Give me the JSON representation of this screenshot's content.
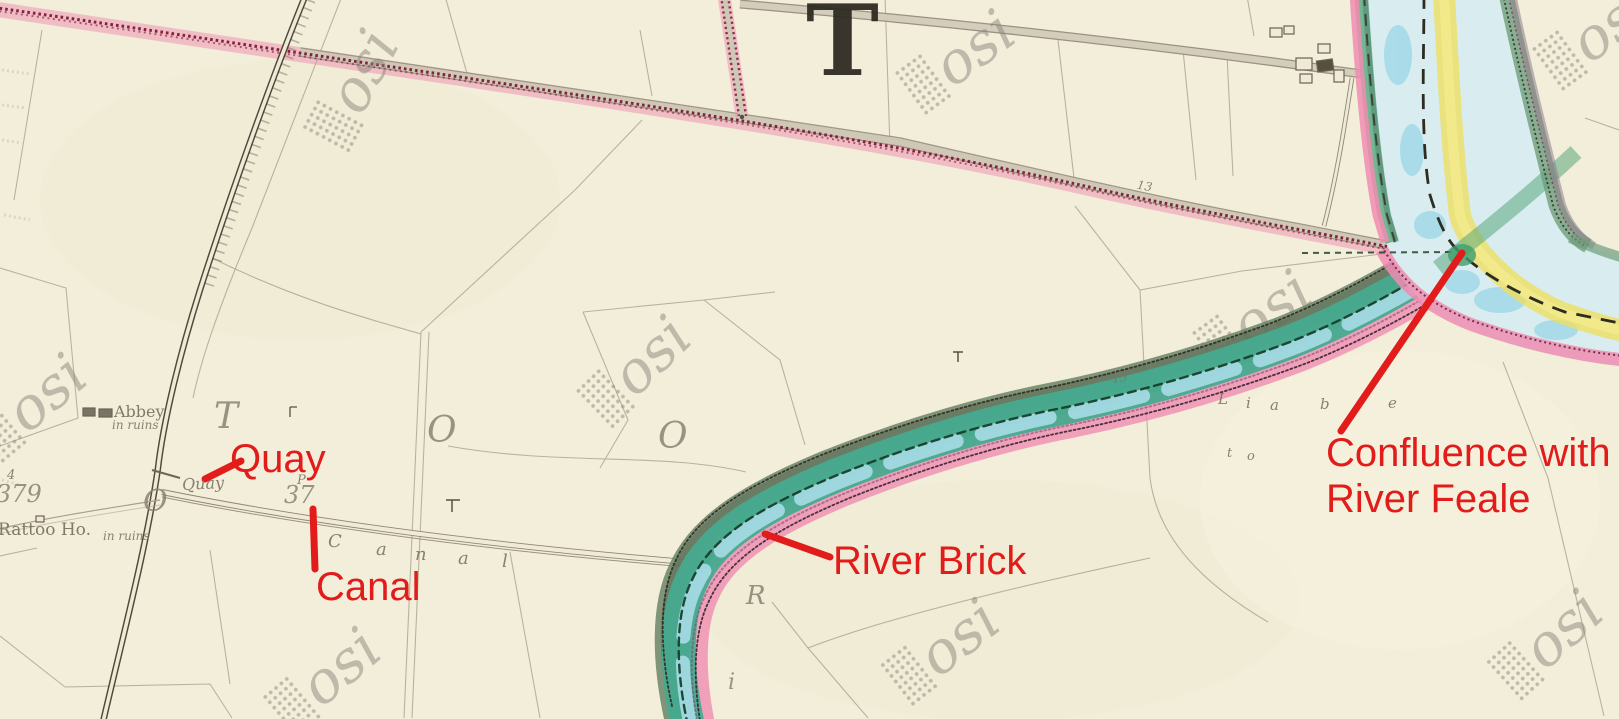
{
  "annotations": {
    "quay": {
      "label": "Quay"
    },
    "canal": {
      "label": "Canal"
    },
    "river_brick": {
      "label": "River Brick"
    },
    "confluence": {
      "line1": "Confluence with",
      "line2": "River Feale"
    },
    "color": "#e21b1b"
  },
  "map_labels": {
    "townland_initial_large": "T",
    "townland_letters": [
      "T",
      "O",
      "O"
    ],
    "o_at_quay": "O",
    "riverside_letters": [
      "R",
      "i"
    ],
    "quay_point": "Quay",
    "canal_spread": [
      "C",
      "a",
      "n",
      "a",
      "l"
    ],
    "abbey": {
      "name": "Abbey",
      "condition": "in ruins"
    },
    "rattoo": {
      "name": "Rattoo Ho.",
      "condition": "in ruins"
    },
    "liable_letters": [
      "L",
      "i",
      "a",
      "b",
      "e"
    ],
    "to_letters": [
      "t",
      "o"
    ],
    "numbers": {
      "bench_small": "4",
      "left_plot": "379",
      "p_small": "P",
      "canal_plot": "37",
      "plot_a": "15",
      "plot_b": "13"
    }
  },
  "watermark": {
    "text": "osi",
    "color": "#8b867c"
  },
  "map_colors": {
    "paper": "#f3eed9",
    "annotation_red": "#e21b1b",
    "river_teal": "#47ab8f",
    "river_pale_blue": "#d9edf1",
    "bank_pink": "#f08cb2",
    "boundary_crimson": "#7c1a36",
    "sand_yellow": "#ecdf63",
    "bank_green": "#5aa87c",
    "road_grey": "#cfc8b6",
    "field_line": "#a59d8d"
  }
}
